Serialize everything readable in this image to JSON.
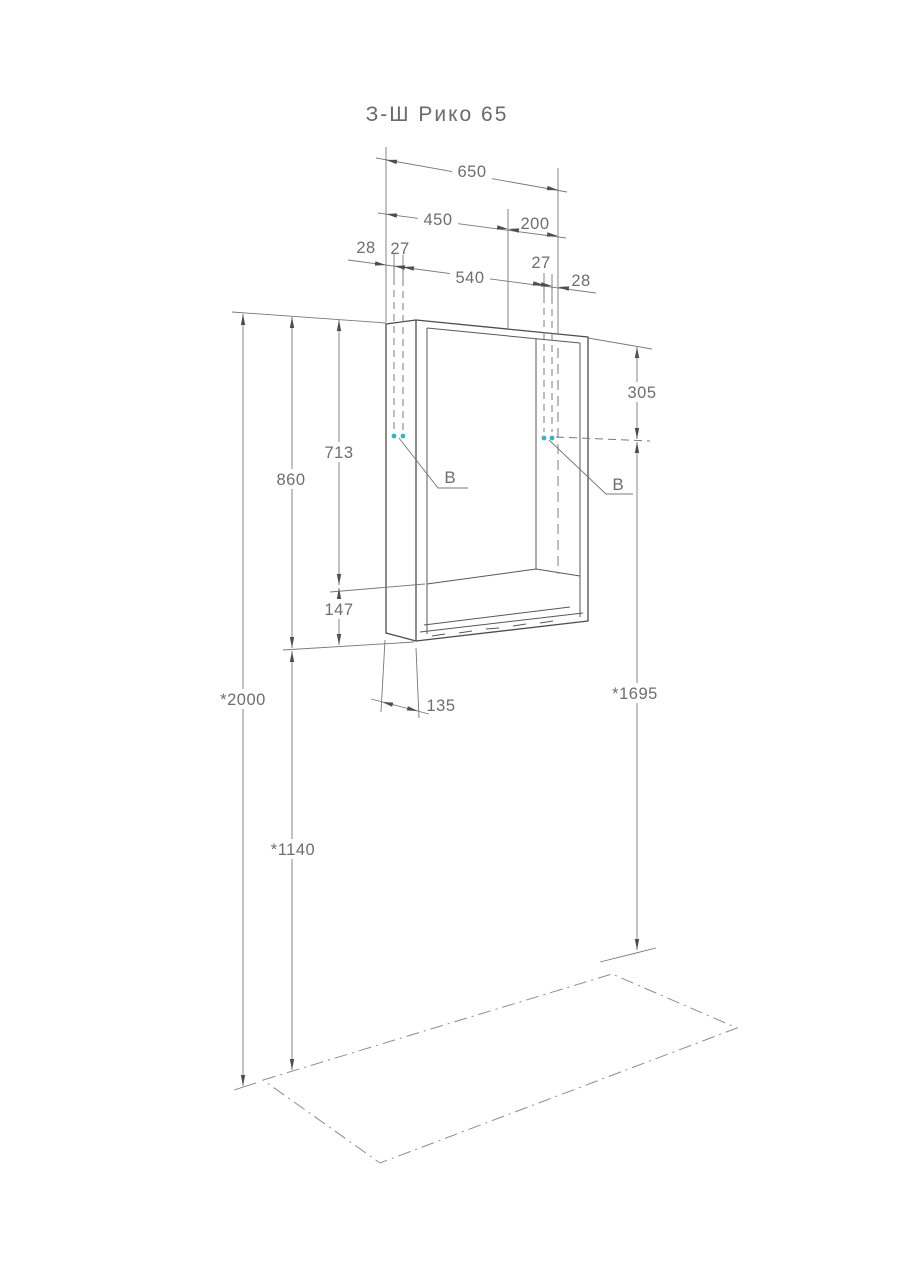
{
  "page": {
    "title": "З-Ш Рико 65"
  },
  "dimensions": {
    "total_width": "650",
    "door_width": "450",
    "shelf_width": "200",
    "left_edge_offset": "28",
    "left_hole_offset": "27",
    "hole_spacing": "540",
    "right_hole_offset": "27",
    "right_edge_offset": "28",
    "top_to_mount": "305",
    "door_height": "713",
    "body_height": "860",
    "shelf_opening_height": "147",
    "depth": "135",
    "floor_to_top": "*2000",
    "floor_to_bottom": "*1140",
    "mount_height": "*1695"
  },
  "labels": {
    "mounting_point": "B"
  },
  "colors": {
    "background": "#ffffff",
    "cabinet_line": "#4d4d4d",
    "dimension_line": "#787878",
    "text": "#6e6e6e",
    "mount_dot": "#3cb1c3"
  }
}
